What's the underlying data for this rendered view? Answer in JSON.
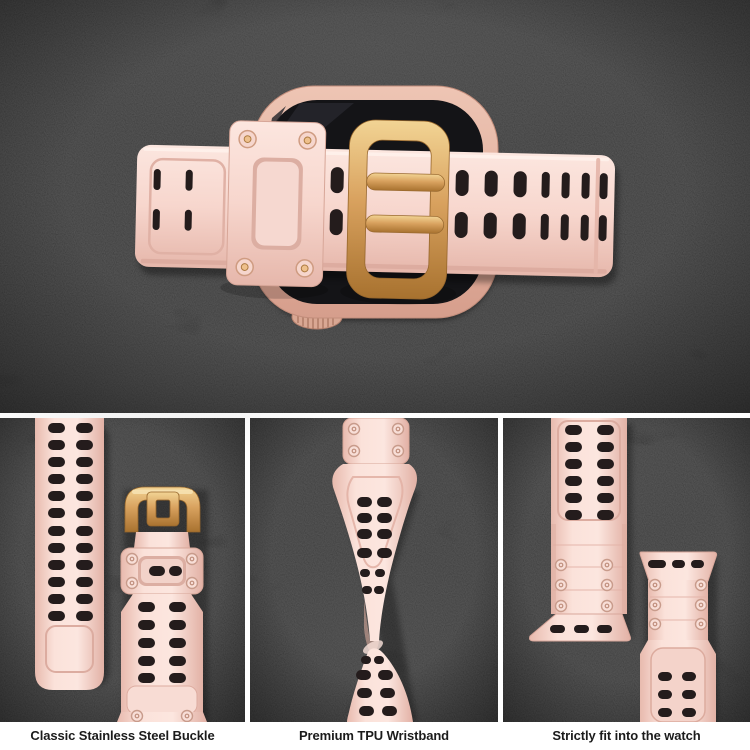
{
  "colors": {
    "background_dark": "#191919",
    "band_pink": "#f7d6cd",
    "band_pink_light": "#fce6df",
    "band_pink_shadow": "#e6b7ab",
    "gold": "#d9a25f",
    "gold_light": "#f2d494",
    "gold_dark": "#a8722f",
    "case_rose_gold_light": "#eec5b4",
    "case_rose_gold": "#d69e8c",
    "screen_black": "#141417",
    "hole_dark": "#241c1c",
    "divider_white": "#ffffff",
    "caption_text": "#1b1b1b"
  },
  "panels": [
    {
      "id": "buckle",
      "caption": "Classic Stainless Steel Buckle"
    },
    {
      "id": "wristband",
      "caption": "Premium TPU Wristband"
    },
    {
      "id": "fit",
      "caption": "Strictly fit into the watch"
    }
  ]
}
